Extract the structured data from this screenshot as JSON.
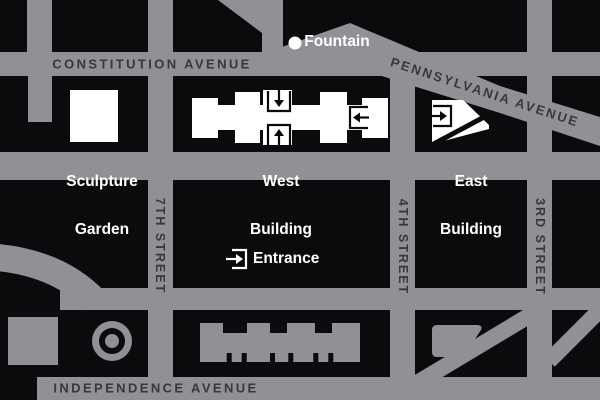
{
  "map": {
    "title": "National Gallery area street map",
    "colors": {
      "street_gray": "#919095",
      "block_black": "#0b0b0d",
      "road_label": "#38373c",
      "building_white": "#ffffff"
    },
    "streets": {
      "constitution": "CONSTITUTION AVENUE",
      "pennsylvania": "PENNSYLVANIA AVENUE",
      "independence": "INDEPENDENCE AVENUE",
      "seventh": "7TH STREET",
      "fourth": "4TH STREET",
      "third": "3RD STREET"
    },
    "landmarks": {
      "mellon_line1": "Mellon",
      "mellon_line2": "Fountain",
      "sculpture_line1": "Sculpture",
      "sculpture_line2": "Garden",
      "west_line1": "West",
      "west_line2": "Building",
      "east_line1": "East",
      "east_line2": "Building"
    },
    "legend": {
      "entrance": "Entrance"
    },
    "icons": {
      "west_building_north": "down-arrow-entrance-icon",
      "west_building_south": "up-arrow-entrance-icon",
      "west_building_east": "left-arrow-entrance-icon",
      "east_building_west": "right-arrow-entrance-icon",
      "legend_marker": "right-arrow-entrance-icon",
      "fountain_marker": "white-dot-icon"
    }
  }
}
